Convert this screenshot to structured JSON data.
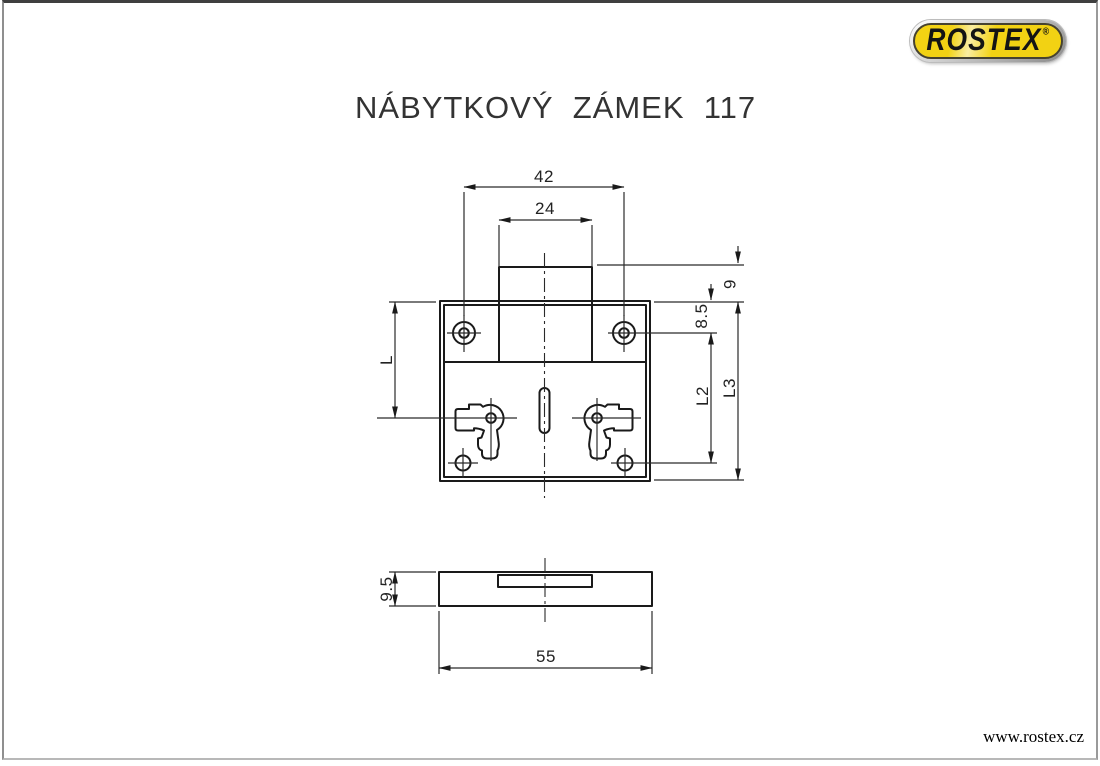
{
  "page": {
    "title": "NÁBYTKOVÝ  ZÁMEK  117",
    "website": "www.rostex.cz"
  },
  "logo": {
    "brand": "ROSTEX",
    "registered": "®",
    "yellow": "#f2d213"
  },
  "front_view": {
    "dim_hole_spacing": "42",
    "dim_tab_width": "24",
    "dim_tab_height": "9",
    "dim_hole_offset": "8.5",
    "dim_l": "L",
    "dim_l2": "L2",
    "dim_l3": "L3"
  },
  "bottom_view": {
    "dim_thickness": "9.5",
    "dim_length": "55"
  },
  "colors": {
    "line": "#1a1a1a"
  }
}
